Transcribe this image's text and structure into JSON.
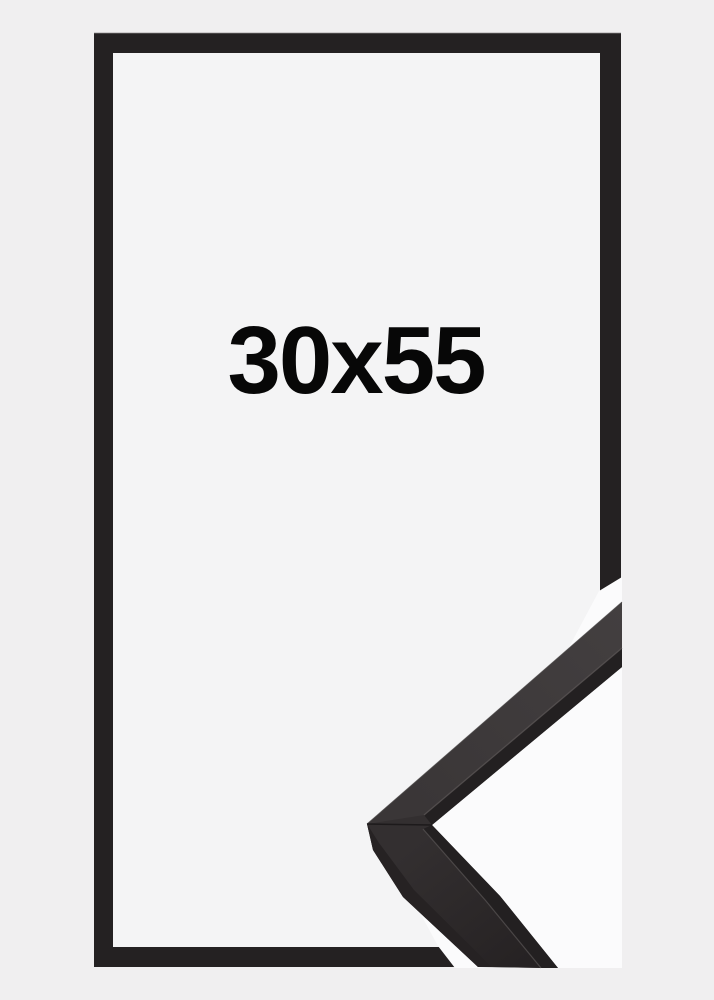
{
  "product_image": {
    "size_label": "30x55",
    "subject": "black picture frame with corner profile detail"
  },
  "colors": {
    "background": "#f0eff0",
    "frame_border": "#242122",
    "frame_edge_highlight": "#8e8c8c",
    "frame_interior": "#f4f4f5",
    "detail_backdrop": "#fbfbfc",
    "label_text": "#070707",
    "moulding_body": "#332f30",
    "moulding_top_face": "#3a3637",
    "moulding_top_face_light": "#433f40",
    "moulding_dark_strip": "#232021",
    "moulding_side_strip": "#262223",
    "moulding_edge_highlight": "#5a5555",
    "moulding_outer_edge_line": "#4c4848",
    "moulding_seam": "#1b1819"
  }
}
